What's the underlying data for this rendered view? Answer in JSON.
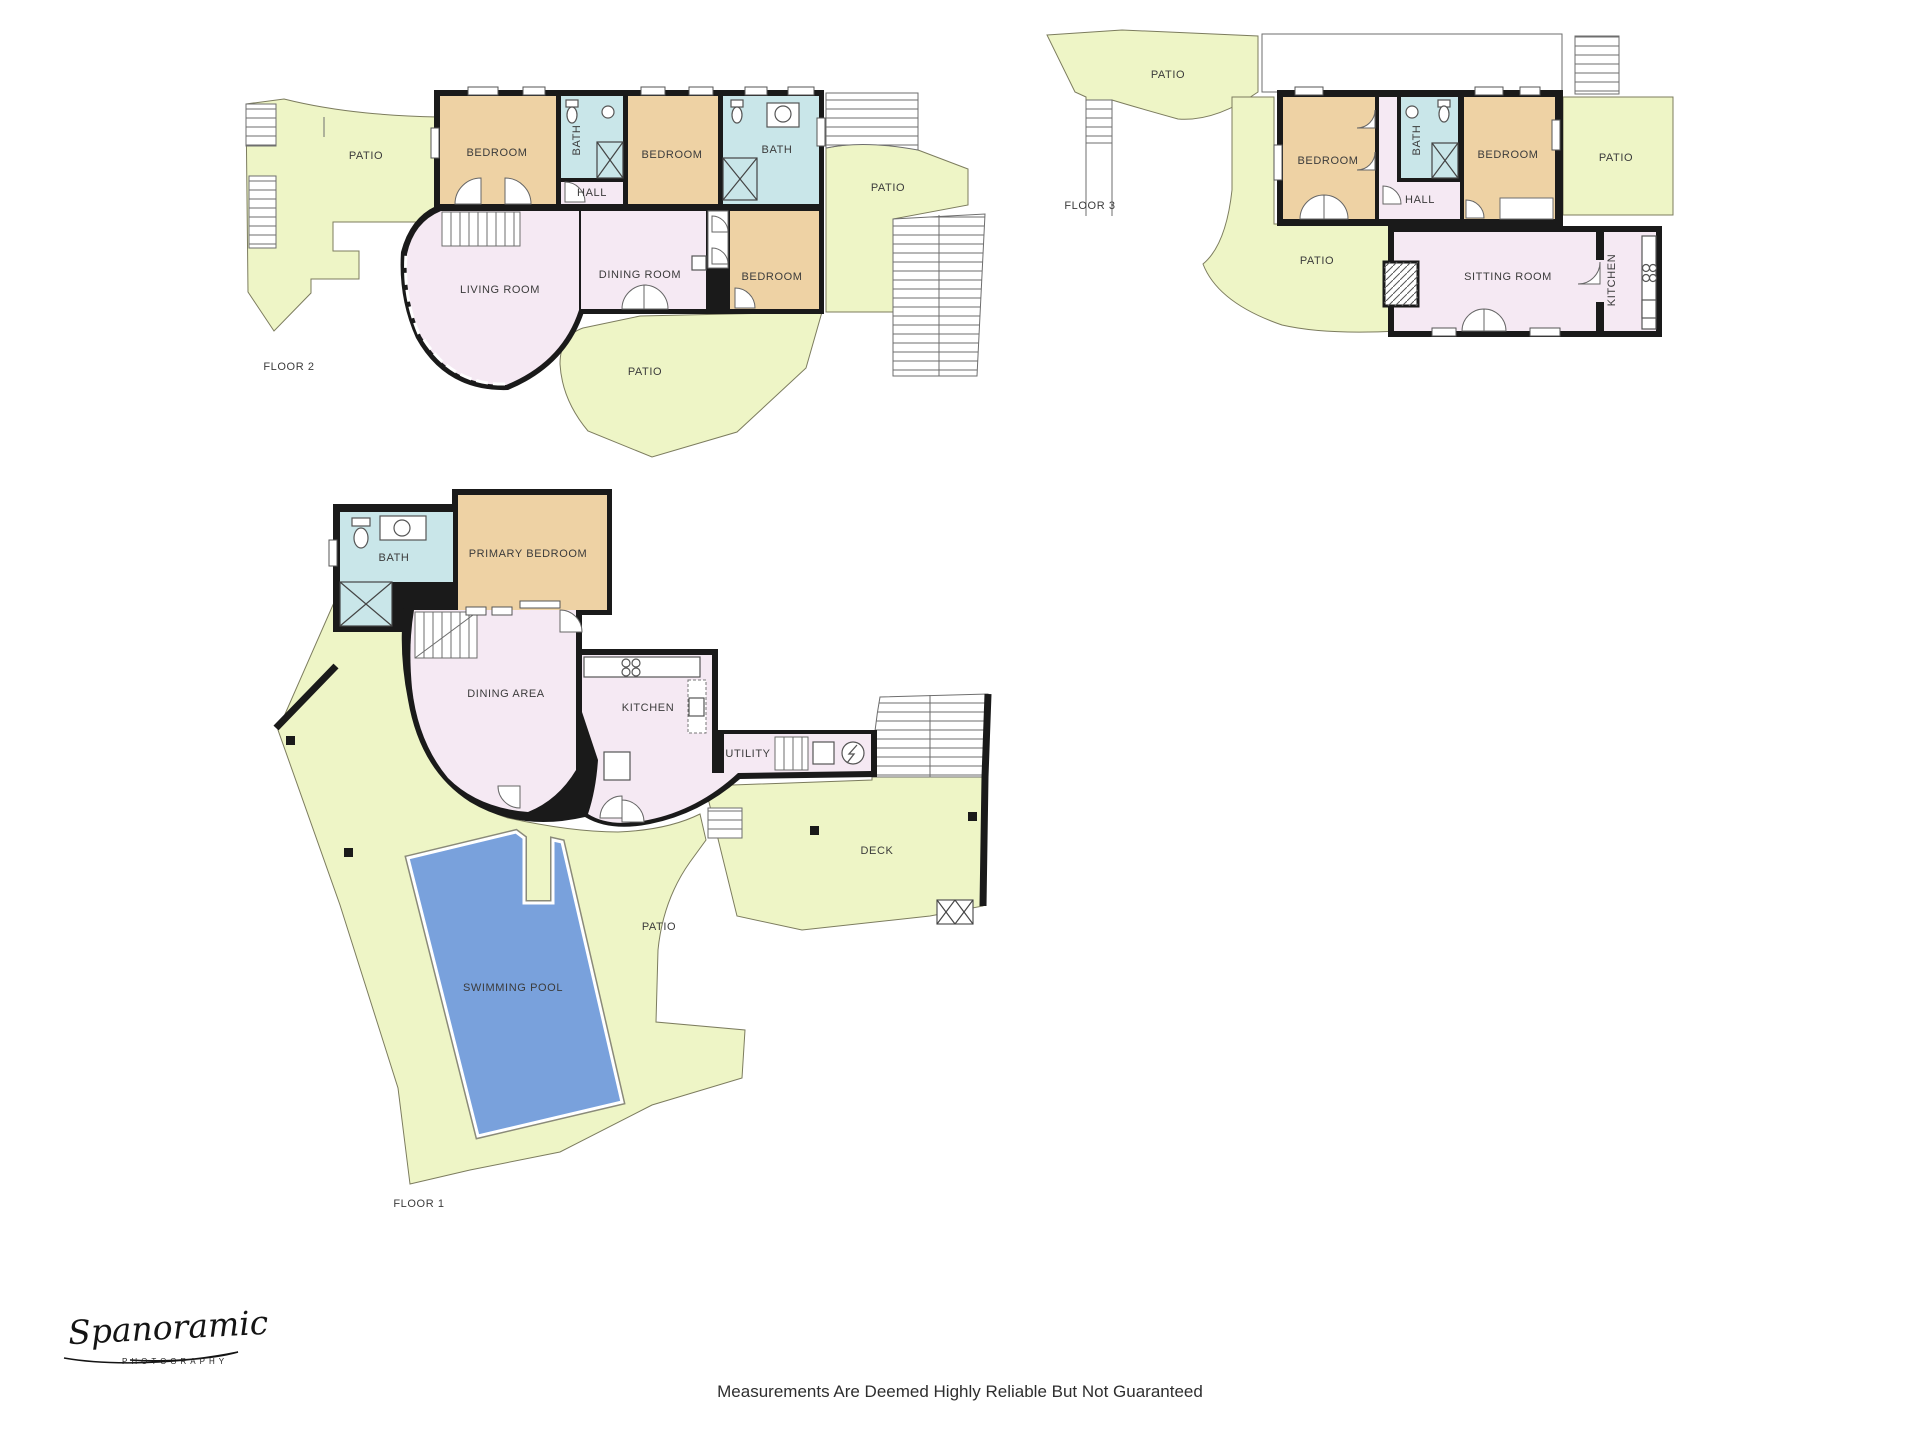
{
  "page": {
    "width": 1920,
    "height": 1440,
    "background": "#ffffff",
    "disclaimer": "Measurements Are Deemed Highly Reliable But Not Guaranteed"
  },
  "branding": {
    "script": "Spanoramic",
    "subtitle": "PHOTOGRAPHY"
  },
  "palette": {
    "patio": "#eef5c6",
    "bedroom": "#eed2a4",
    "bath": "#c9e6e9",
    "living": "#f5e9f3",
    "pool": "#79a1dc",
    "wall": "#1a1a1a",
    "label": "#3b3b3b"
  },
  "floors": [
    {
      "id": "floor2",
      "name": "FLOOR 2",
      "name_pos": {
        "x": 289,
        "y": 367
      },
      "labels": [
        {
          "text": "PATIO",
          "x": 366,
          "y": 156
        },
        {
          "text": "BEDROOM",
          "x": 497,
          "y": 153
        },
        {
          "text": "BATH",
          "x": 577,
          "y": 140,
          "rotate": -90
        },
        {
          "text": "BEDROOM",
          "x": 672,
          "y": 155
        },
        {
          "text": "BATH",
          "x": 777,
          "y": 150
        },
        {
          "text": "HALL",
          "x": 592,
          "y": 193
        },
        {
          "text": "LIVING ROOM",
          "x": 500,
          "y": 290
        },
        {
          "text": "DINING ROOM",
          "x": 640,
          "y": 275
        },
        {
          "text": "BEDROOM",
          "x": 772,
          "y": 277
        },
        {
          "text": "PATIO",
          "x": 888,
          "y": 188
        },
        {
          "text": "PATIO",
          "x": 645,
          "y": 372
        }
      ]
    },
    {
      "id": "floor3",
      "name": "FLOOR 3",
      "name_pos": {
        "x": 1090,
        "y": 206
      },
      "labels": [
        {
          "text": "PATIO",
          "x": 1168,
          "y": 75
        },
        {
          "text": "BEDROOM",
          "x": 1328,
          "y": 161
        },
        {
          "text": "BATH",
          "x": 1417,
          "y": 140,
          "rotate": -90
        },
        {
          "text": "BEDROOM",
          "x": 1508,
          "y": 155
        },
        {
          "text": "PATIO",
          "x": 1616,
          "y": 158
        },
        {
          "text": "HALL",
          "x": 1420,
          "y": 200
        },
        {
          "text": "PATIO",
          "x": 1317,
          "y": 261
        },
        {
          "text": "SITTING ROOM",
          "x": 1508,
          "y": 277
        },
        {
          "text": "KITCHEN",
          "x": 1612,
          "y": 280,
          "rotate": -90
        }
      ]
    },
    {
      "id": "floor1",
      "name": "FLOOR 1",
      "name_pos": {
        "x": 419,
        "y": 1204
      },
      "labels": [
        {
          "text": "BATH",
          "x": 394,
          "y": 558
        },
        {
          "text": "PRIMARY BEDROOM",
          "x": 528,
          "y": 554
        },
        {
          "text": "DINING AREA",
          "x": 506,
          "y": 694
        },
        {
          "text": "KITCHEN",
          "x": 648,
          "y": 708
        },
        {
          "text": "UTILITY",
          "x": 748,
          "y": 754
        },
        {
          "text": "DECK",
          "x": 877,
          "y": 851
        },
        {
          "text": "PATIO",
          "x": 659,
          "y": 927
        },
        {
          "text": "SWIMMING POOL",
          "x": 513,
          "y": 988
        }
      ]
    }
  ]
}
